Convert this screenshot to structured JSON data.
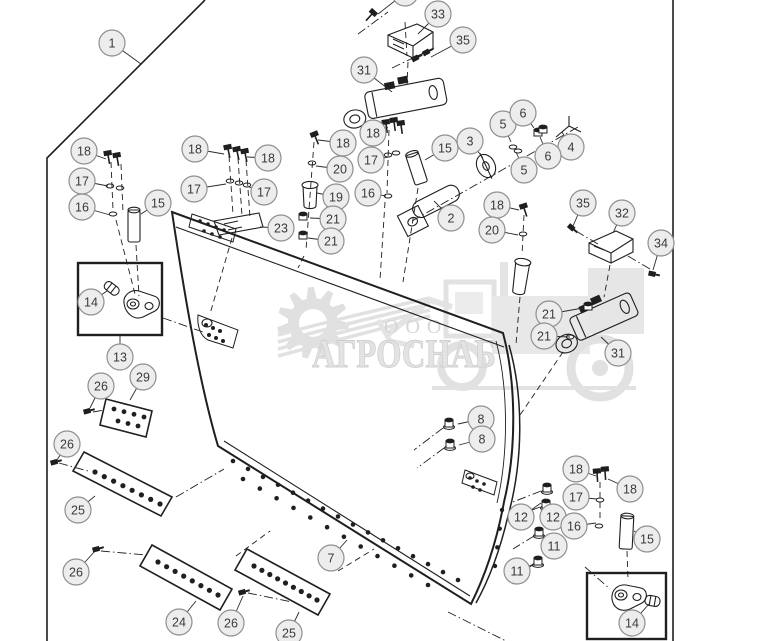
{
  "watermark": {
    "line1": "ООО",
    "line2": "АГРОСНАБ"
  },
  "diagram": {
    "type": "exploded-parts-diagram",
    "subject": "dozer-blade-assembly",
    "colors": {
      "line": "#1f1f1f",
      "callout_fill": "#ededed",
      "callout_stroke": "#8f8f8f",
      "callout_text": "#3a3a3a",
      "watermark": "#c6c6c6",
      "watermark_text": "#bdbdbd"
    },
    "callouts": [
      {
        "label": "1",
        "x": 112,
        "y": 43,
        "lx": 141,
        "ly": 64
      },
      {
        "label": "",
        "x": 405,
        "y": -7,
        "lx": 378,
        "ly": 14
      },
      {
        "label": "33",
        "x": 438,
        "y": 14,
        "lx": 418,
        "ly": 34
      },
      {
        "label": "35",
        "x": 463,
        "y": 40,
        "lx": 431,
        "ly": 57
      },
      {
        "label": "31",
        "x": 364,
        "y": 70,
        "lx": 392,
        "ly": 92
      },
      {
        "label": "18",
        "x": 84,
        "y": 151,
        "lx": 106,
        "ly": 159
      },
      {
        "label": "17",
        "x": 82,
        "y": 181,
        "lx": 108,
        "ly": 186
      },
      {
        "label": "16",
        "x": 82,
        "y": 207,
        "lx": 110,
        "ly": 215
      },
      {
        "label": "15",
        "x": 158,
        "y": 203,
        "lx": 141,
        "ly": 214
      },
      {
        "label": "18",
        "x": 195,
        "y": 149,
        "lx": 224,
        "ly": 154
      },
      {
        "label": "18",
        "x": 268,
        "y": 158,
        "lx": 247,
        "ly": 157
      },
      {
        "label": "17",
        "x": 194,
        "y": 189,
        "lx": 226,
        "ly": 184
      },
      {
        "label": "17",
        "x": 264,
        "y": 192,
        "lx": 249,
        "ly": 187
      },
      {
        "label": "23",
        "x": 281,
        "y": 228,
        "lx": 260,
        "ly": 227
      },
      {
        "label": "18",
        "x": 343,
        "y": 143,
        "lx": 318,
        "ly": 140
      },
      {
        "label": "20",
        "x": 340,
        "y": 169,
        "lx": 316,
        "ly": 166
      },
      {
        "label": "19",
        "x": 336,
        "y": 197,
        "lx": 317,
        "ly": 193
      },
      {
        "label": "21",
        "x": 333,
        "y": 219,
        "lx": 310,
        "ly": 218
      },
      {
        "label": "21",
        "x": 331,
        "y": 241,
        "lx": 308,
        "ly": 238
      },
      {
        "label": "18",
        "x": 373,
        "y": 133,
        "lx": 388,
        "ly": 127
      },
      {
        "label": "17",
        "x": 371,
        "y": 160,
        "lx": 389,
        "ly": 157
      },
      {
        "label": "16",
        "x": 368,
        "y": 193,
        "lx": 386,
        "ly": 196
      },
      {
        "label": "15",
        "x": 445,
        "y": 148,
        "lx": 425,
        "ly": 160
      },
      {
        "label": "3",
        "x": 470,
        "y": 141,
        "lx": 483,
        "ly": 158
      },
      {
        "label": "5",
        "x": 503,
        "y": 124,
        "lx": 511,
        "ly": 142
      },
      {
        "label": "6",
        "x": 523,
        "y": 113,
        "lx": 534,
        "ly": 128
      },
      {
        "label": "4",
        "x": 571,
        "y": 147,
        "lx": 562,
        "ly": 132
      },
      {
        "label": "6",
        "x": 548,
        "y": 156,
        "lx": 540,
        "ly": 137
      },
      {
        "label": "5",
        "x": 524,
        "y": 170,
        "lx": 516,
        "ly": 152
      },
      {
        "label": "2",
        "x": 451,
        "y": 218,
        "lx": 434,
        "ly": 201
      },
      {
        "label": "18",
        "x": 497,
        "y": 205,
        "lx": 519,
        "ly": 210
      },
      {
        "label": "20",
        "x": 492,
        "y": 230,
        "lx": 518,
        "ly": 235
      },
      {
        "label": "35",
        "x": 583,
        "y": 203,
        "lx": 573,
        "ly": 226
      },
      {
        "label": "32",
        "x": 622,
        "y": 213,
        "lx": 613,
        "ly": 233
      },
      {
        "label": "34",
        "x": 661,
        "y": 243,
        "lx": 653,
        "ly": 270
      },
      {
        "label": "21",
        "x": 549,
        "y": 314,
        "lx": 583,
        "ly": 308
      },
      {
        "label": "21",
        "x": 544,
        "y": 336,
        "lx": 570,
        "ly": 337
      },
      {
        "label": "31",
        "x": 618,
        "y": 353,
        "lx": 601,
        "ly": 337
      },
      {
        "label": "14",
        "x": 91,
        "y": 302,
        "lx": 107,
        "ly": 291
      },
      {
        "label": "13",
        "x": 120,
        "y": 357,
        "lx": 120,
        "ly": 336
      },
      {
        "label": "26",
        "x": 101,
        "y": 386,
        "lx": 90,
        "ly": 408
      },
      {
        "label": "29",
        "x": 143,
        "y": 377,
        "lx": 130,
        "ly": 400
      },
      {
        "label": "26",
        "x": 67,
        "y": 444,
        "lx": 57,
        "ly": 460
      },
      {
        "label": "25",
        "x": 78,
        "y": 510,
        "lx": 95,
        "ly": 496
      },
      {
        "label": "26",
        "x": 76,
        "y": 572,
        "lx": 95,
        "ly": 551
      },
      {
        "label": "24",
        "x": 179,
        "y": 622,
        "lx": 196,
        "ly": 601
      },
      {
        "label": "26",
        "x": 231,
        "y": 623,
        "lx": 243,
        "ly": 596
      },
      {
        "label": "25",
        "x": 289,
        "y": 633,
        "lx": 299,
        "ly": 612
      },
      {
        "label": "7",
        "x": 331,
        "y": 558,
        "lx": 347,
        "ly": 540
      },
      {
        "label": "8",
        "x": 481,
        "y": 419,
        "lx": 458,
        "ly": 424
      },
      {
        "label": "8",
        "x": 482,
        "y": 439,
        "lx": 459,
        "ly": 445
      },
      {
        "label": "12",
        "x": 521,
        "y": 517,
        "lx": 541,
        "ly": 503
      },
      {
        "label": "12",
        "x": 553,
        "y": 517,
        "lx": 549,
        "ly": 506
      },
      {
        "label": "11",
        "x": 554,
        "y": 546,
        "lx": 543,
        "ly": 536
      },
      {
        "label": "11",
        "x": 517,
        "y": 571,
        "lx": 534,
        "ly": 564
      },
      {
        "label": "18",
        "x": 576,
        "y": 469,
        "lx": 596,
        "ly": 476
      },
      {
        "label": "18",
        "x": 630,
        "y": 489,
        "lx": 608,
        "ly": 479
      },
      {
        "label": "17",
        "x": 576,
        "y": 497,
        "lx": 597,
        "ly": 499
      },
      {
        "label": "16",
        "x": 574,
        "y": 526,
        "lx": 596,
        "ly": 523
      },
      {
        "label": "15",
        "x": 647,
        "y": 539,
        "lx": 634,
        "ly": 531
      },
      {
        "label": "14",
        "x": 632,
        "y": 623,
        "lx": 649,
        "ly": 604
      }
    ]
  }
}
